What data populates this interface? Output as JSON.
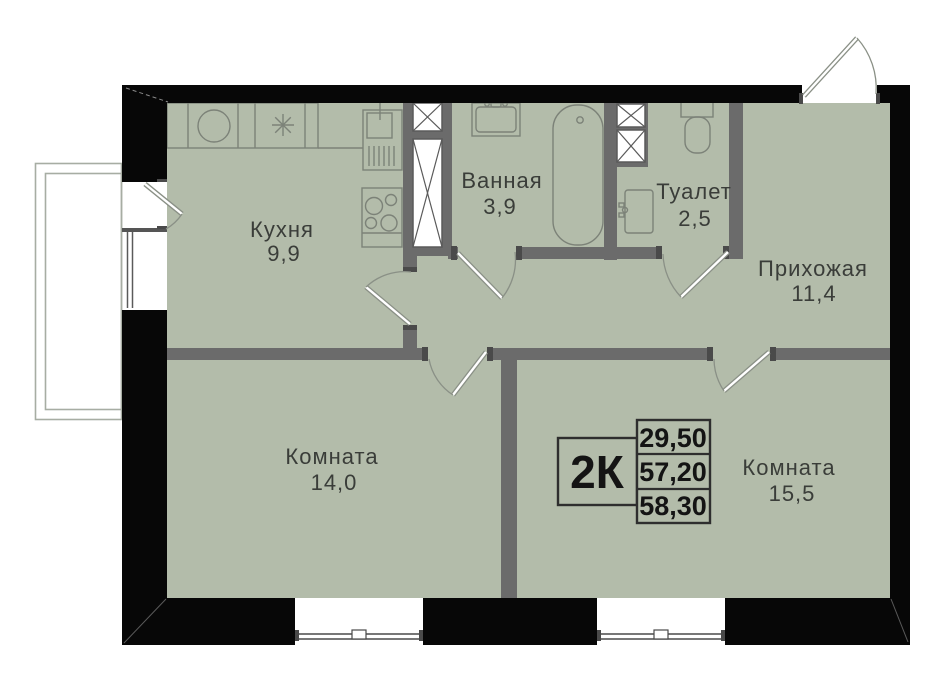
{
  "legend": {
    "type_label": "2К",
    "rows": [
      "29,50",
      "57,20",
      "58,30"
    ]
  },
  "rooms": {
    "kitchen": {
      "name": "Кухня",
      "area": "9,9"
    },
    "bathroom": {
      "name": "Ванная",
      "area": "3,9"
    },
    "toilet": {
      "name": "Туалет",
      "area": "2,5"
    },
    "hallway": {
      "name": "Прихожая",
      "area": "11,4"
    },
    "room_left": {
      "name": "Комната",
      "area": "14,0"
    },
    "room_right": {
      "name": "Комната",
      "area": "15,5"
    }
  },
  "colors": {
    "background": "#ffffff",
    "floor": "#b3bcaa",
    "exterior_wall": "#070707",
    "interior_wall": "#6b6b6b",
    "fixture_line": "#7c8278",
    "door_line": "#8a9086",
    "label_text": "#3a3d39",
    "legend_text": "#141414",
    "legend_border": "#2e2e2e"
  }
}
